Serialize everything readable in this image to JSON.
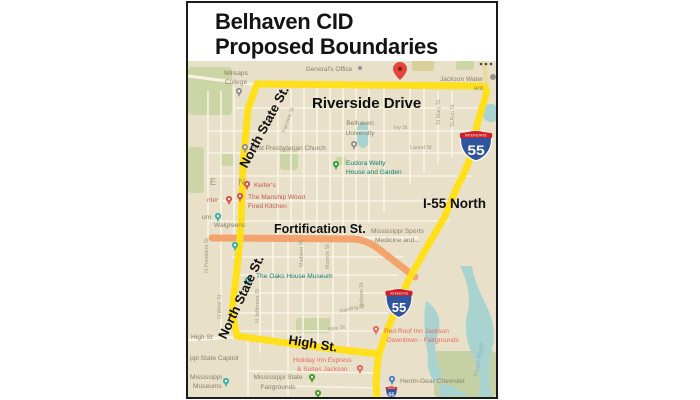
{
  "title": {
    "line1": "Belhaven CID",
    "line2": "Proposed Boundaries"
  },
  "overlays": {
    "riverside_drive": "Riverside Drive",
    "north_state_upper": "North State St.",
    "north_state_lower": "North State St.",
    "fortification": "Fortification St.",
    "i55_north": "I-55 North",
    "high_st": "High St."
  },
  "shield": {
    "top": "INTERSTATE",
    "number": "55"
  },
  "pois": {
    "millsaps_1": "Millsaps",
    "millsaps_2": "College",
    "generals_office": "General's Office",
    "jackson_water_1": "Jackson Water",
    "jackson_water_2": "ent",
    "belhaven_univ_1": "Belhaven",
    "belhaven_univ_2": "University",
    "first_presbyterian": "First Presbyterian Church",
    "eudora_1": "Eudora Welty",
    "eudora_2": "House and Garden",
    "keifers": "Keifer's",
    "manship_1": "The Manship Wood",
    "manship_2": "Fired Kitchen",
    "center_partial": "nter",
    "museum_partial": "um",
    "walgreens": "Walgreens",
    "ms_sports_1": "Mississippi Sports",
    "ms_sports_2": "Medicine and...",
    "oaks_museum": "The Oaks House Museum",
    "high_st_small": "High St",
    "capitol_partial": "ppi State Capitol",
    "ms_museums_1": "Mississippi",
    "ms_museums_2": "Museums",
    "fairgrounds_1": "Mississippi State",
    "fairgrounds_2": "Fairgrounds",
    "holiday_inn_1": "Holiday Inn Express",
    "holiday_inn_2": "& Suites Jackson",
    "red_roof_1": "Red Roof Inn Jackson",
    "red_roof_2": "Downtown - Fairgrounds",
    "herrin_gear": "Herrin-Gear Chevrolet",
    "pearl_river": "Pearl River",
    "belhaven_letters": "E N"
  },
  "streets": {
    "laurel": "Laurel St",
    "ivy": "Ivy St",
    "st_mary": "St Mary St",
    "st_ann": "St Ann St",
    "fairview": "Fairview St",
    "n_jefferson": "N Jefferson St",
    "n_west": "N West St",
    "n_president": "N President St",
    "madison": "Madison St",
    "monroe": "Monroe St",
    "harding": "Harding St",
    "vine": "Vine St",
    "jackson": "Jackson St"
  },
  "colors": {
    "boundary_yellow": "#ffe01a",
    "fortification_orange": "#f2a36e",
    "map_background": "#e9e0ca",
    "road_white": "#f8f3e6",
    "park_green": "#ccd5a6",
    "water_teal": "#a8d3d0",
    "shield_blue": "#32549c",
    "shield_red": "#ce2029",
    "lodging_pink": "#e8695f",
    "poi_gray": "#8a8068",
    "water_label_blue": "#8fb0c9",
    "marker_red": "#e2453c"
  }
}
